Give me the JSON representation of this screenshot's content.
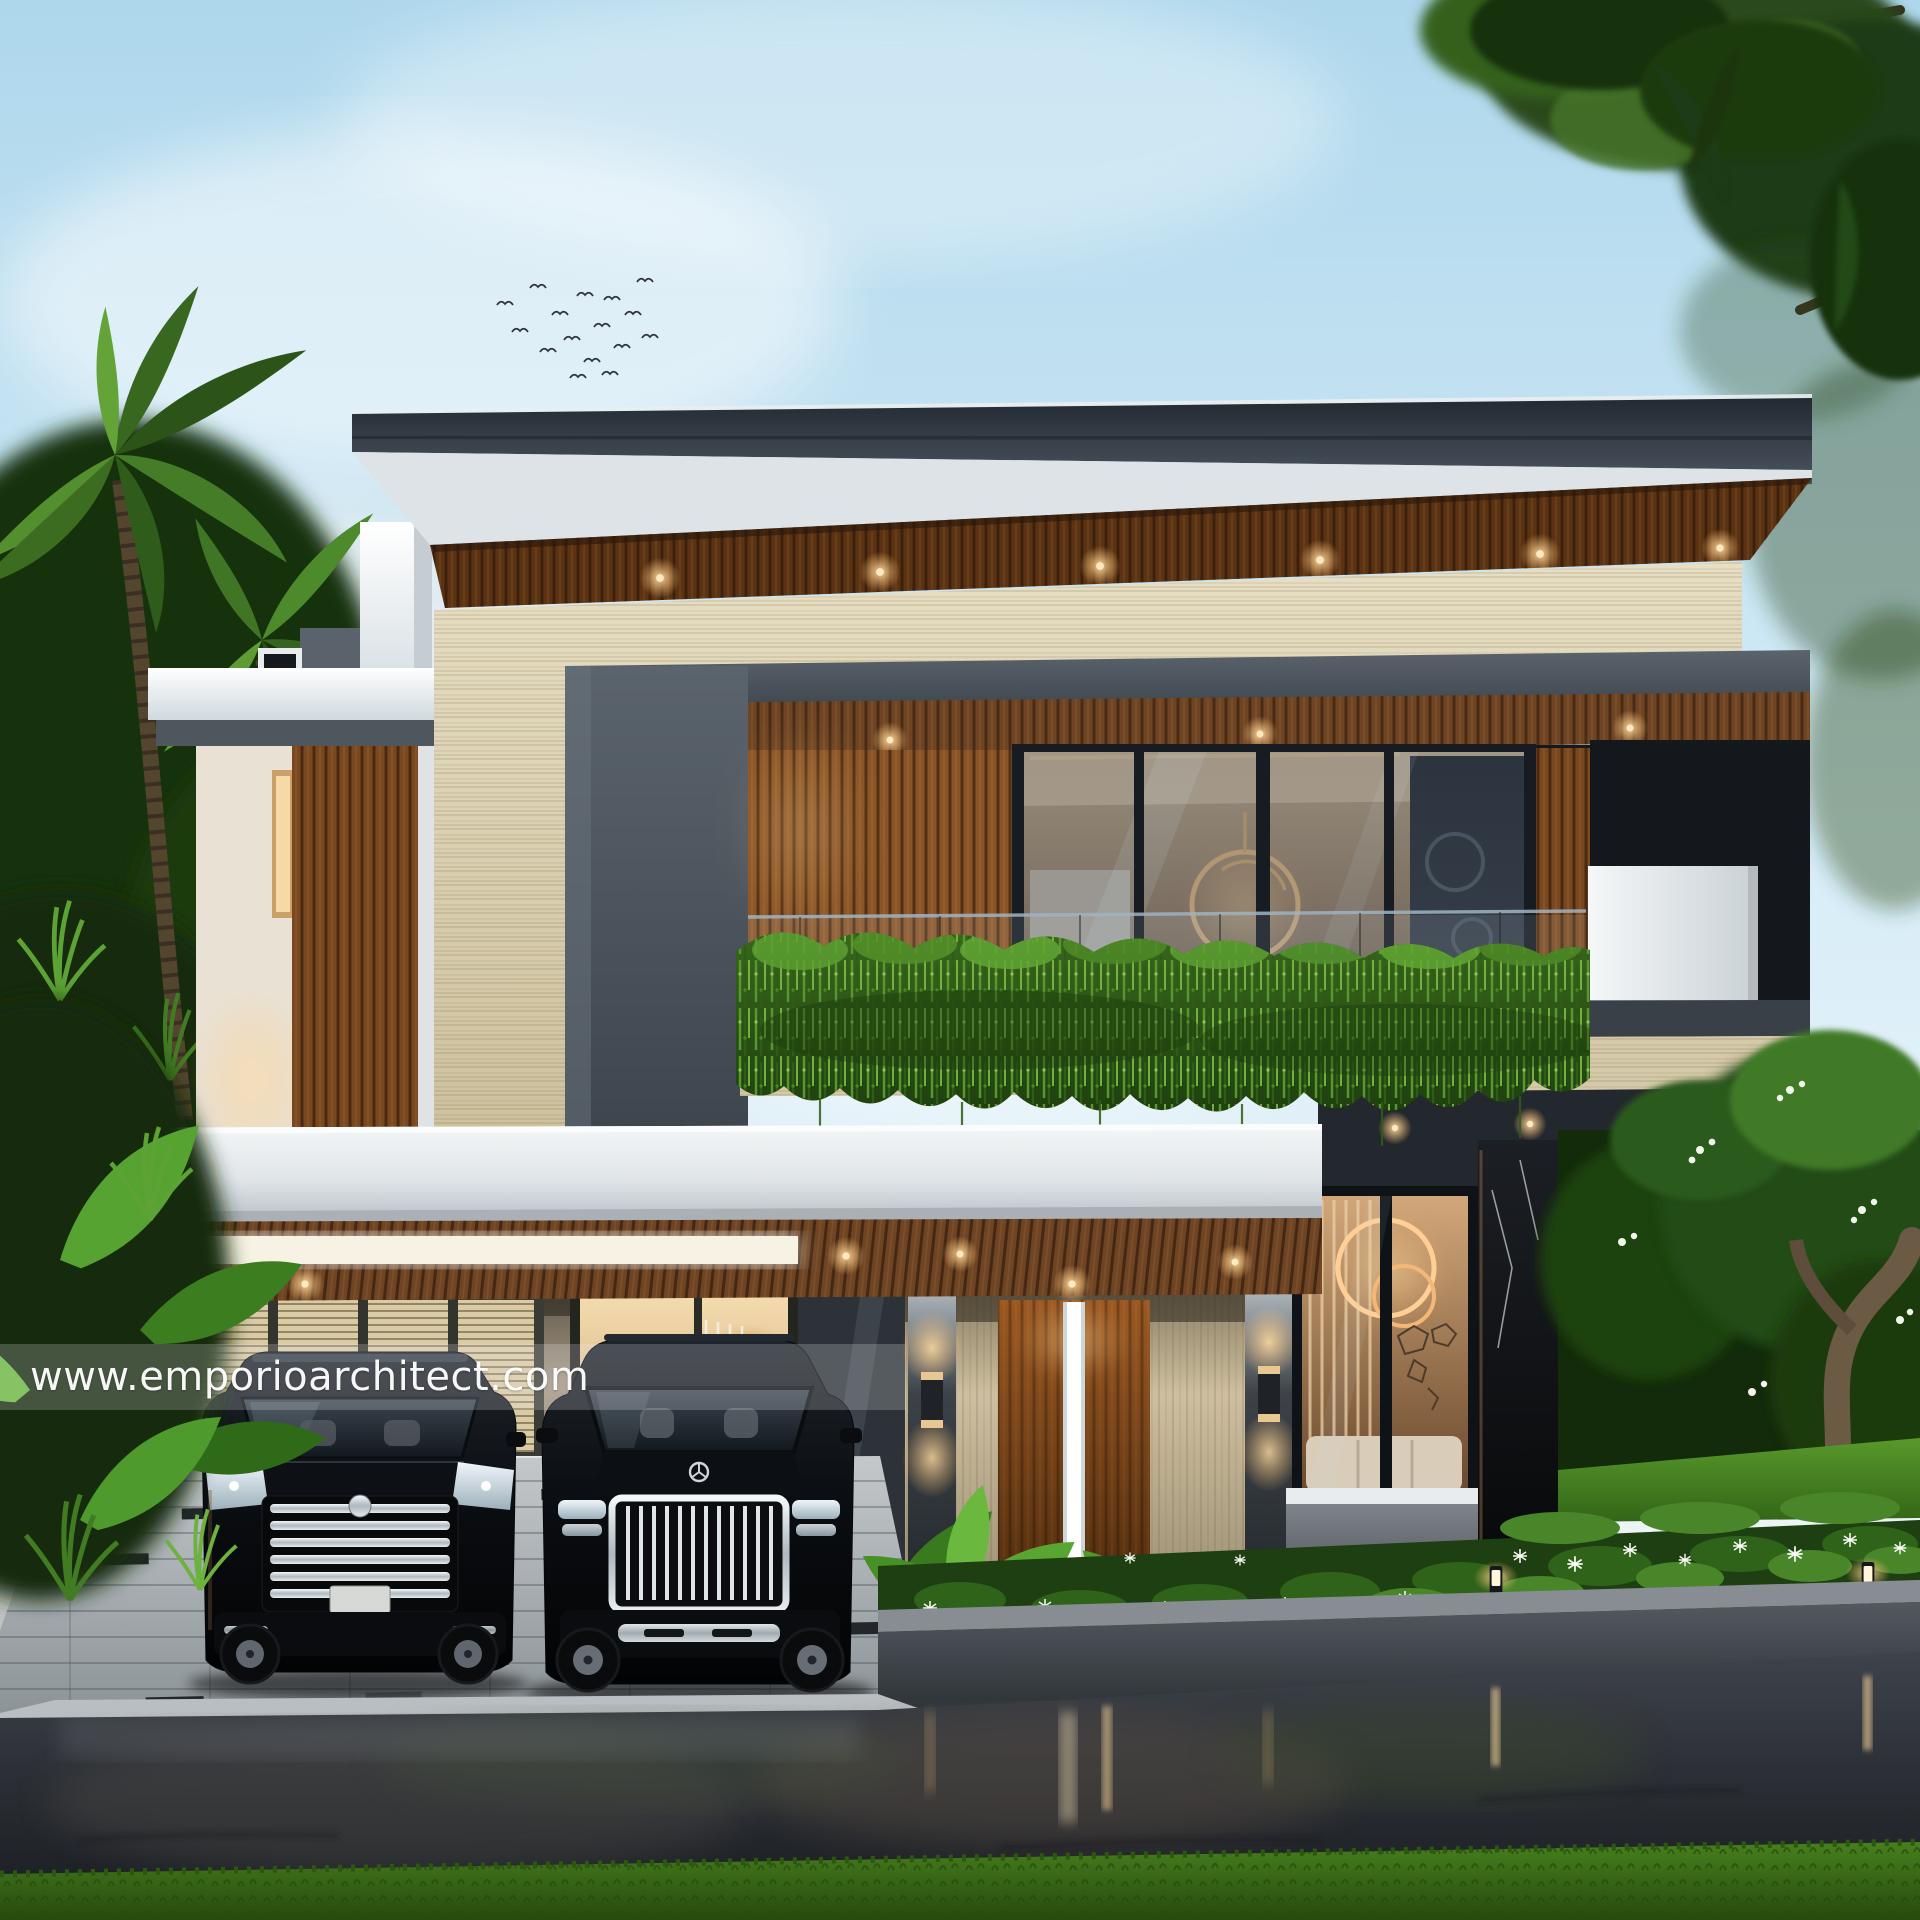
{
  "watermark": {
    "text": "www.emporioarchitect.com"
  },
  "scene": {
    "kind": "3D architectural exterior rendering at dusk, after rain",
    "subject": "modern two-storey tropical villa with flat charcoal roof, timber-slat ceilings, travertine walls, glass balcony covered by hanging vines",
    "vehicles": [
      "black luxury MPV parked in carport",
      "black luxury SUV parked in carport"
    ],
    "landscape": [
      "coconut palms on the left",
      "large tree canopy top right",
      "frangipani tree and flowering shrubs on the right",
      "white spider-lily flower bed with bollard lights",
      "wet asphalt road with light reflections",
      "grass strip in the foreground"
    ],
    "lighting": [
      "warm recessed downlights under roof soffits",
      "up-down wall sconces on entrance pillars",
      "glowing interior ring chandeliers",
      "white recessed light panel in carport ceiling",
      "garden bollard lights"
    ]
  },
  "palette": {
    "sky_blue": "#bfe0f0",
    "roof_charcoal": "#323a43",
    "timber": "#7a4a22",
    "travertine": "#ddd2b4",
    "concrete_grey": "#4d565f",
    "white_trim": "#eef1f3",
    "foliage_dark": "#1e3c12",
    "vine_green": "#4c8a28",
    "interior_glow": "#e9c08a",
    "car_black": "#0b0e12",
    "chrome": "#dfe5e9",
    "wet_road": "#2b2f35",
    "grass": "#3f7218"
  }
}
